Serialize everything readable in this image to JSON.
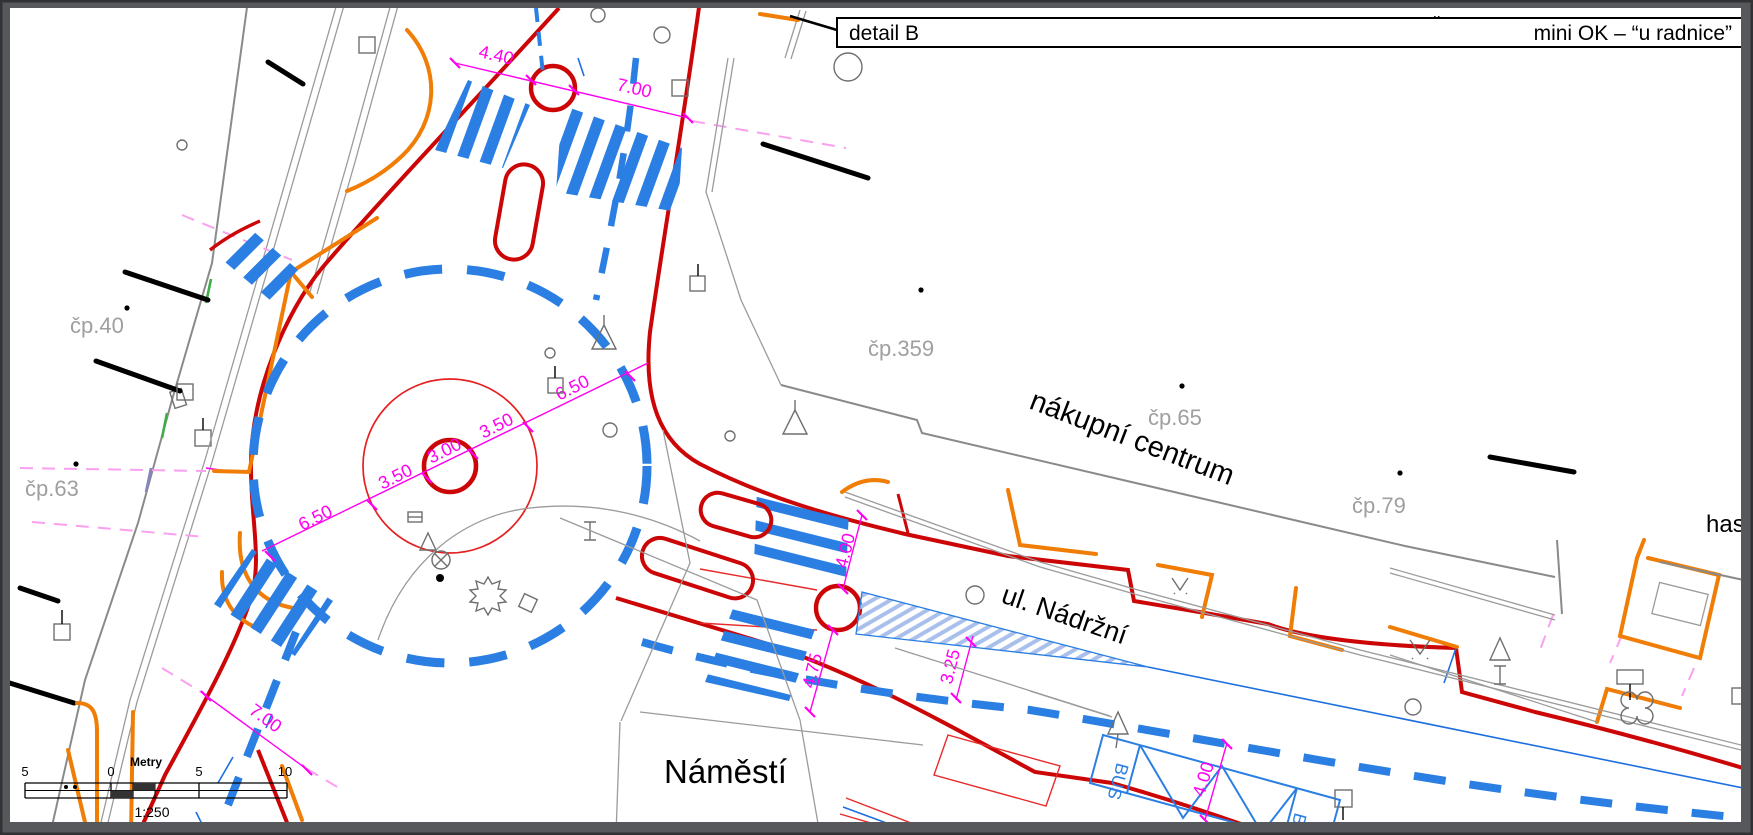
{
  "title_block": {
    "detail_label": "detail B",
    "project_label": "mini OK – “u radnice”",
    "stray_mark": "¨"
  },
  "place_labels": {
    "shopping_center": "nákupní centrum",
    "street_nadrzni": "ul. Nádržní",
    "square_namesti": "Náměstí",
    "right_edge_partial": "has"
  },
  "parcel_labels": {
    "cp40": "čp.40",
    "cp63": "čp.63",
    "cp359": "čp.359",
    "cp65": "čp.65",
    "cp79": "čp.79"
  },
  "dimensions": {
    "north_island_left": "4.40",
    "north_island_right": "7.00",
    "ring_outer_left": "6.50",
    "ring_lane_left": "3.50",
    "ring_island": "3.00",
    "ring_lane_right": "3.50",
    "ring_outer_right": "6.50",
    "east_crossing_upper": "4.00",
    "east_crossing_lower": "4.75",
    "east_lane": "3.25",
    "southwest_crossing": "7.00",
    "bus_bay_width": "4.00"
  },
  "bus_stop": {
    "label_left": "BUS",
    "label_right": "BUS"
  },
  "scale_bar": {
    "title": "Metry",
    "tick_minus5": "5",
    "tick_0": "0",
    "tick_5": "5",
    "tick_10": "10",
    "ratio": "1:250"
  },
  "colors": {
    "carriageway_edge_red": "#cc0606",
    "marking_blue": "#2b7fe3",
    "curb_orange": "#f07d05",
    "dimension_magenta": "#ff00f0",
    "sightline_pink": "#f9a0f0",
    "building_gray": "#8a8a8a",
    "parcel_text_gray": "#9f9f9f",
    "frame_gray": "#56585b"
  }
}
